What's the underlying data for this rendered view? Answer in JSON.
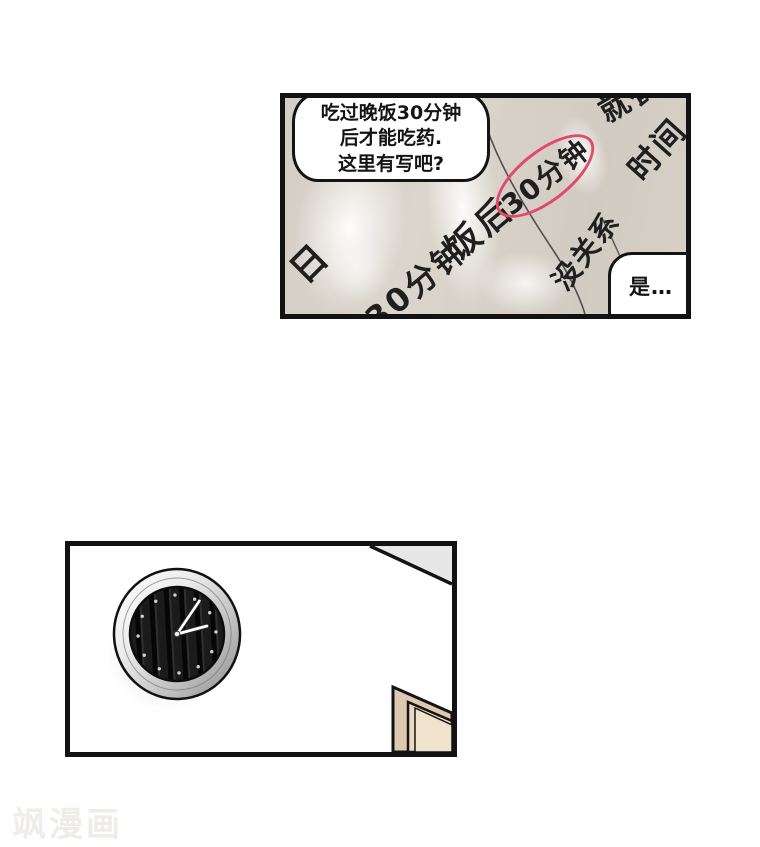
{
  "page": {
    "watermark": "飒漫画",
    "background": "#ffffff"
  },
  "panel1": {
    "question_bubble": {
      "lines": [
        "吃过晚饭30分钟",
        "后才能吃药.",
        "这里有写吧?"
      ]
    },
    "reply_bubble": {
      "text": "是…"
    },
    "paper_texts": {
      "ri": "日",
      "min30_a": "30分钟",
      "fanhou": "饭后",
      "min30_circled": "30分钟",
      "meiguanxi": "没关系",
      "shijian": "时间",
      "jiucan": "就餐"
    },
    "colors": {
      "paper": "#d6d0c7",
      "fold_highlight": "#ffffff",
      "circle_red": "#e2496a",
      "ink": "#1f1f1f",
      "panel_border": "#121212"
    }
  },
  "panel2": {
    "colors": {
      "wall": "#ffffff",
      "clock_rim": "#c9c9c9",
      "clock_face": "#181818",
      "clock_hands": "#ffffff",
      "door_frame": "#dcc9b0",
      "door_inner": "#e9d9c1",
      "ceiling_corner": "#e7e7e7"
    }
  }
}
